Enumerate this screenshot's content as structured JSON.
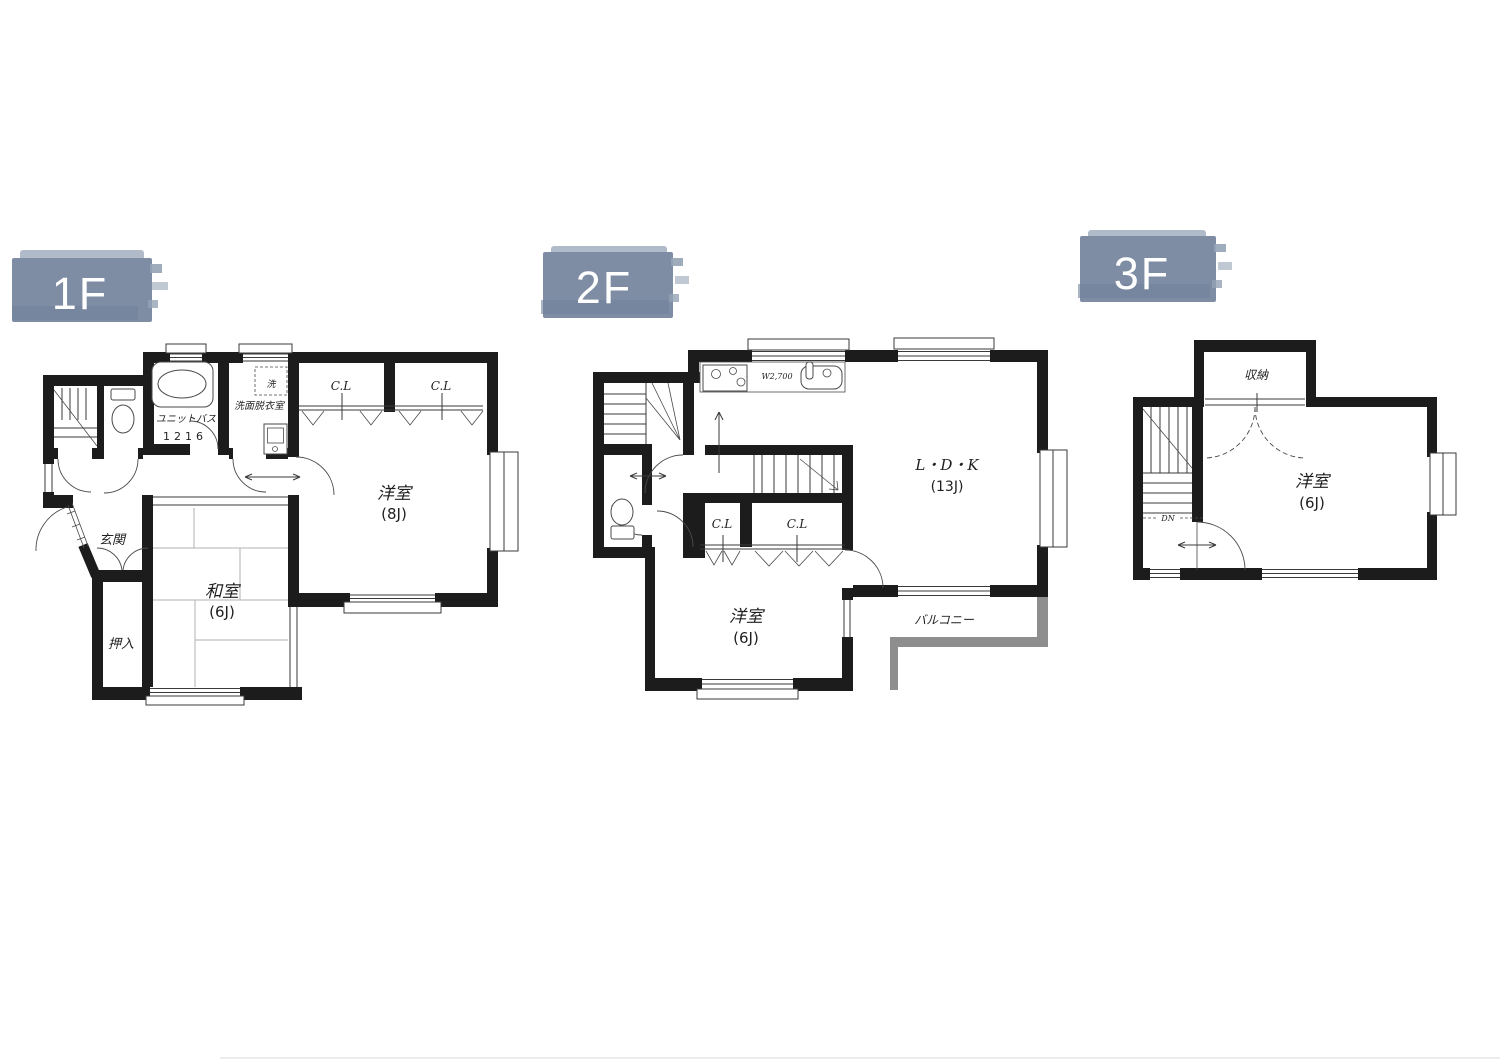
{
  "palette": {
    "background": "#ffffff",
    "wall": "#1c1c1c",
    "thin_line": "#3a3a3a",
    "balcony_wall": "#8e8e8e",
    "tatami_line": "#b2b2b2",
    "badge_fill": "#7e8da4",
    "badge_fill_light": "#95a3b5",
    "badge_fill_dark": "#71829b",
    "badge_text_color": "#ffffff"
  },
  "floor_1f": {
    "badge": "1F",
    "genkan": "玄関",
    "oshiire": "押入",
    "washitsu": "和室",
    "washitsu_size": "(6J)",
    "yoshitsu": "洋室",
    "yoshitsu_size": "(8J)",
    "closet_left": "C.L",
    "closet_right": "C.L",
    "unit_bath": "ユニットバス",
    "unit_bath_size": "1216",
    "senmen_datsuiishitsu": "洗面脱衣室",
    "laundry": "洗"
  },
  "floor_2f": {
    "badge": "2F",
    "ldk": "L・D・K",
    "ldk_size": "(13J)",
    "yoshitsu": "洋室",
    "yoshitsu_size": "(6J)",
    "closet_left": "C.L",
    "closet_right": "C.L",
    "balcony": "バルコニー",
    "kitchen_width": "W2,700"
  },
  "floor_3f": {
    "badge": "3F",
    "shunou": "収納",
    "yoshitsu": "洋室",
    "yoshitsu_size": "(6J)",
    "stairs_direction": "DN"
  }
}
